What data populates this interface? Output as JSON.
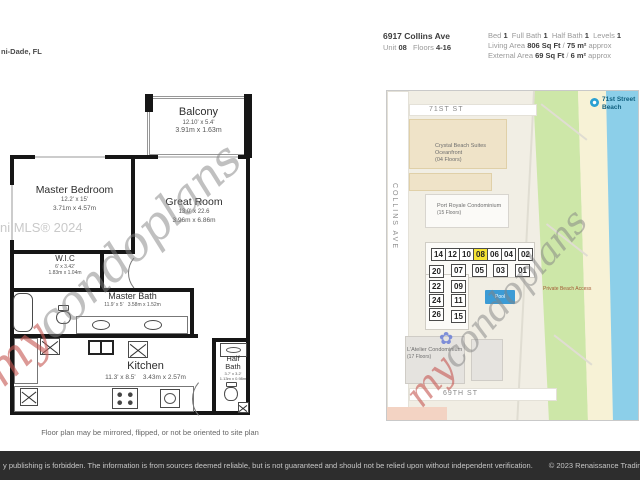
{
  "page": {
    "location": "ni-Dade, FL",
    "note": "Floor plan may be mirrored, flipped, or not be oriented to site plan",
    "mls_watermark": "ni MLS® 2024",
    "watermark": {
      "prefix": "my",
      "suffix": "condoplans"
    }
  },
  "header": {
    "address": "6917 Collins Ave",
    "unit_label": "Unit",
    "unit": "08",
    "floors_label": "Floors",
    "floors": "4-16",
    "bed_label": "Bed",
    "bed": "1",
    "full_bath_label": "Full Bath",
    "full_bath": "1",
    "half_bath_label": "Half Bath",
    "half_bath": "1",
    "levels_label": "Levels",
    "levels": "1",
    "living_area_label": "Living Area",
    "living_area": "806 Sq Ft",
    "living_area_sep": "/",
    "living_area_metric": "75 m²",
    "living_area_approx": "approx",
    "external_area_label": "External Area",
    "external_area": "69 Sq Ft",
    "external_area_sep": "/",
    "external_area_metric": "6 m²",
    "external_area_approx": "approx"
  },
  "floorplan": {
    "balcony": {
      "name": "Balcony",
      "imperial": "12.10' x 5.4'",
      "metric": "3.91m x 1.63m"
    },
    "master_bedroom": {
      "name": "Master Bedroom",
      "imperial": "12.2' x 15'",
      "metric": "3.71m x 4.57m"
    },
    "great_room": {
      "name": "Great Room",
      "imperial": "13.0' x 22.6",
      "metric": "3.96m x 6.86m"
    },
    "wic": {
      "name": "W.I.C",
      "imperial": "6' x 3.42'",
      "metric": "1.83m x 1.04m"
    },
    "master_bath": {
      "name": "Master Bath",
      "imperial": "11.9' x 5'",
      "metric": "3.58m x 1.52m"
    },
    "kitchen": {
      "name": "Kitchen",
      "imperial": "11.3' x 8.5'",
      "metric": "3.43m x 2.57m"
    },
    "half_bath": {
      "name_l1": "Half",
      "name_l2": "Bath",
      "imperial": "3.7' x 3.2'",
      "metric": "1.13m x 0.98m"
    }
  },
  "map": {
    "street_71": "71ST ST",
    "street_collins": "COLLINS AVE",
    "street_69": "69TH ST",
    "beach_label_l1": "71st Street",
    "beach_label_l2": "Beach",
    "private_access": "Private Beach Access",
    "pool_label": "Pool",
    "buildings": {
      "crystal": {
        "l1": "Crystal Beach Suites",
        "l2": "Oceanfront",
        "l3": "(04 Floors)"
      },
      "port": {
        "l1": "Port Royale Condominium",
        "l2": "(15 Floors)"
      },
      "latelier": {
        "l1": "L'Atelier Condominium",
        "l2": "(17 Floors)"
      }
    },
    "units": {
      "r1": [
        "14",
        "12",
        "10",
        "08",
        "06",
        "04",
        "02"
      ],
      "r2": [
        "20",
        "07",
        "05",
        "03",
        "01"
      ],
      "c1": [
        "22",
        "24",
        "26"
      ],
      "c2": [
        "09",
        "11",
        "15"
      ],
      "highlighted": "08"
    }
  },
  "footer": {
    "disclaimer": "y publishing is forbidden. The information is from sources deemed reliable, but is not guaranteed and should not be relied upon without independent verification.",
    "copyright": "© 2023 Renaissance Trading C"
  },
  "colors": {
    "highlight_unit": "#f6e434",
    "pool": "#3c9bd5",
    "water": "#8ccfe9",
    "sand": "#f7f2d6",
    "green": "#cde7a8",
    "footer_bg": "#2d2d2d",
    "watermark_red": "#c75a55",
    "watermark_gray": "#828282"
  }
}
